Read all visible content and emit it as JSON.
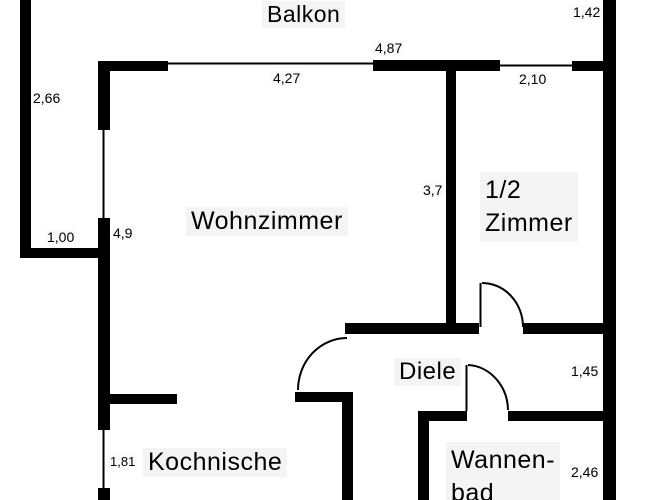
{
  "plan": {
    "type": "floor-plan",
    "language": "de",
    "colors": {
      "wall": "#000000",
      "background": "#ffffff"
    },
    "rooms": {
      "balkon": "Balkon",
      "wohnzimmer": "Wohnzimmer",
      "halbzimmer_line1": "1/2",
      "halbzimmer_line2": "Zimmer",
      "diele": "Diele",
      "kochnische": "Kochnische",
      "wannenbad_line1": "Wannen-",
      "wannenbad_line2": "bad"
    },
    "dimensions": {
      "balkon_right": "1,42",
      "left_outer": "2,66",
      "balkon_front": "4,87",
      "wohnzimmer_window": "4,27",
      "halbzimmer_window": "2,10",
      "divider_wall": "3,7",
      "wohnzimmer_left": "4,9",
      "left_entry": "1,00",
      "diele_right": "1,45",
      "kochnische_window": "1,81",
      "wannenbad_right": "2,46"
    }
  }
}
